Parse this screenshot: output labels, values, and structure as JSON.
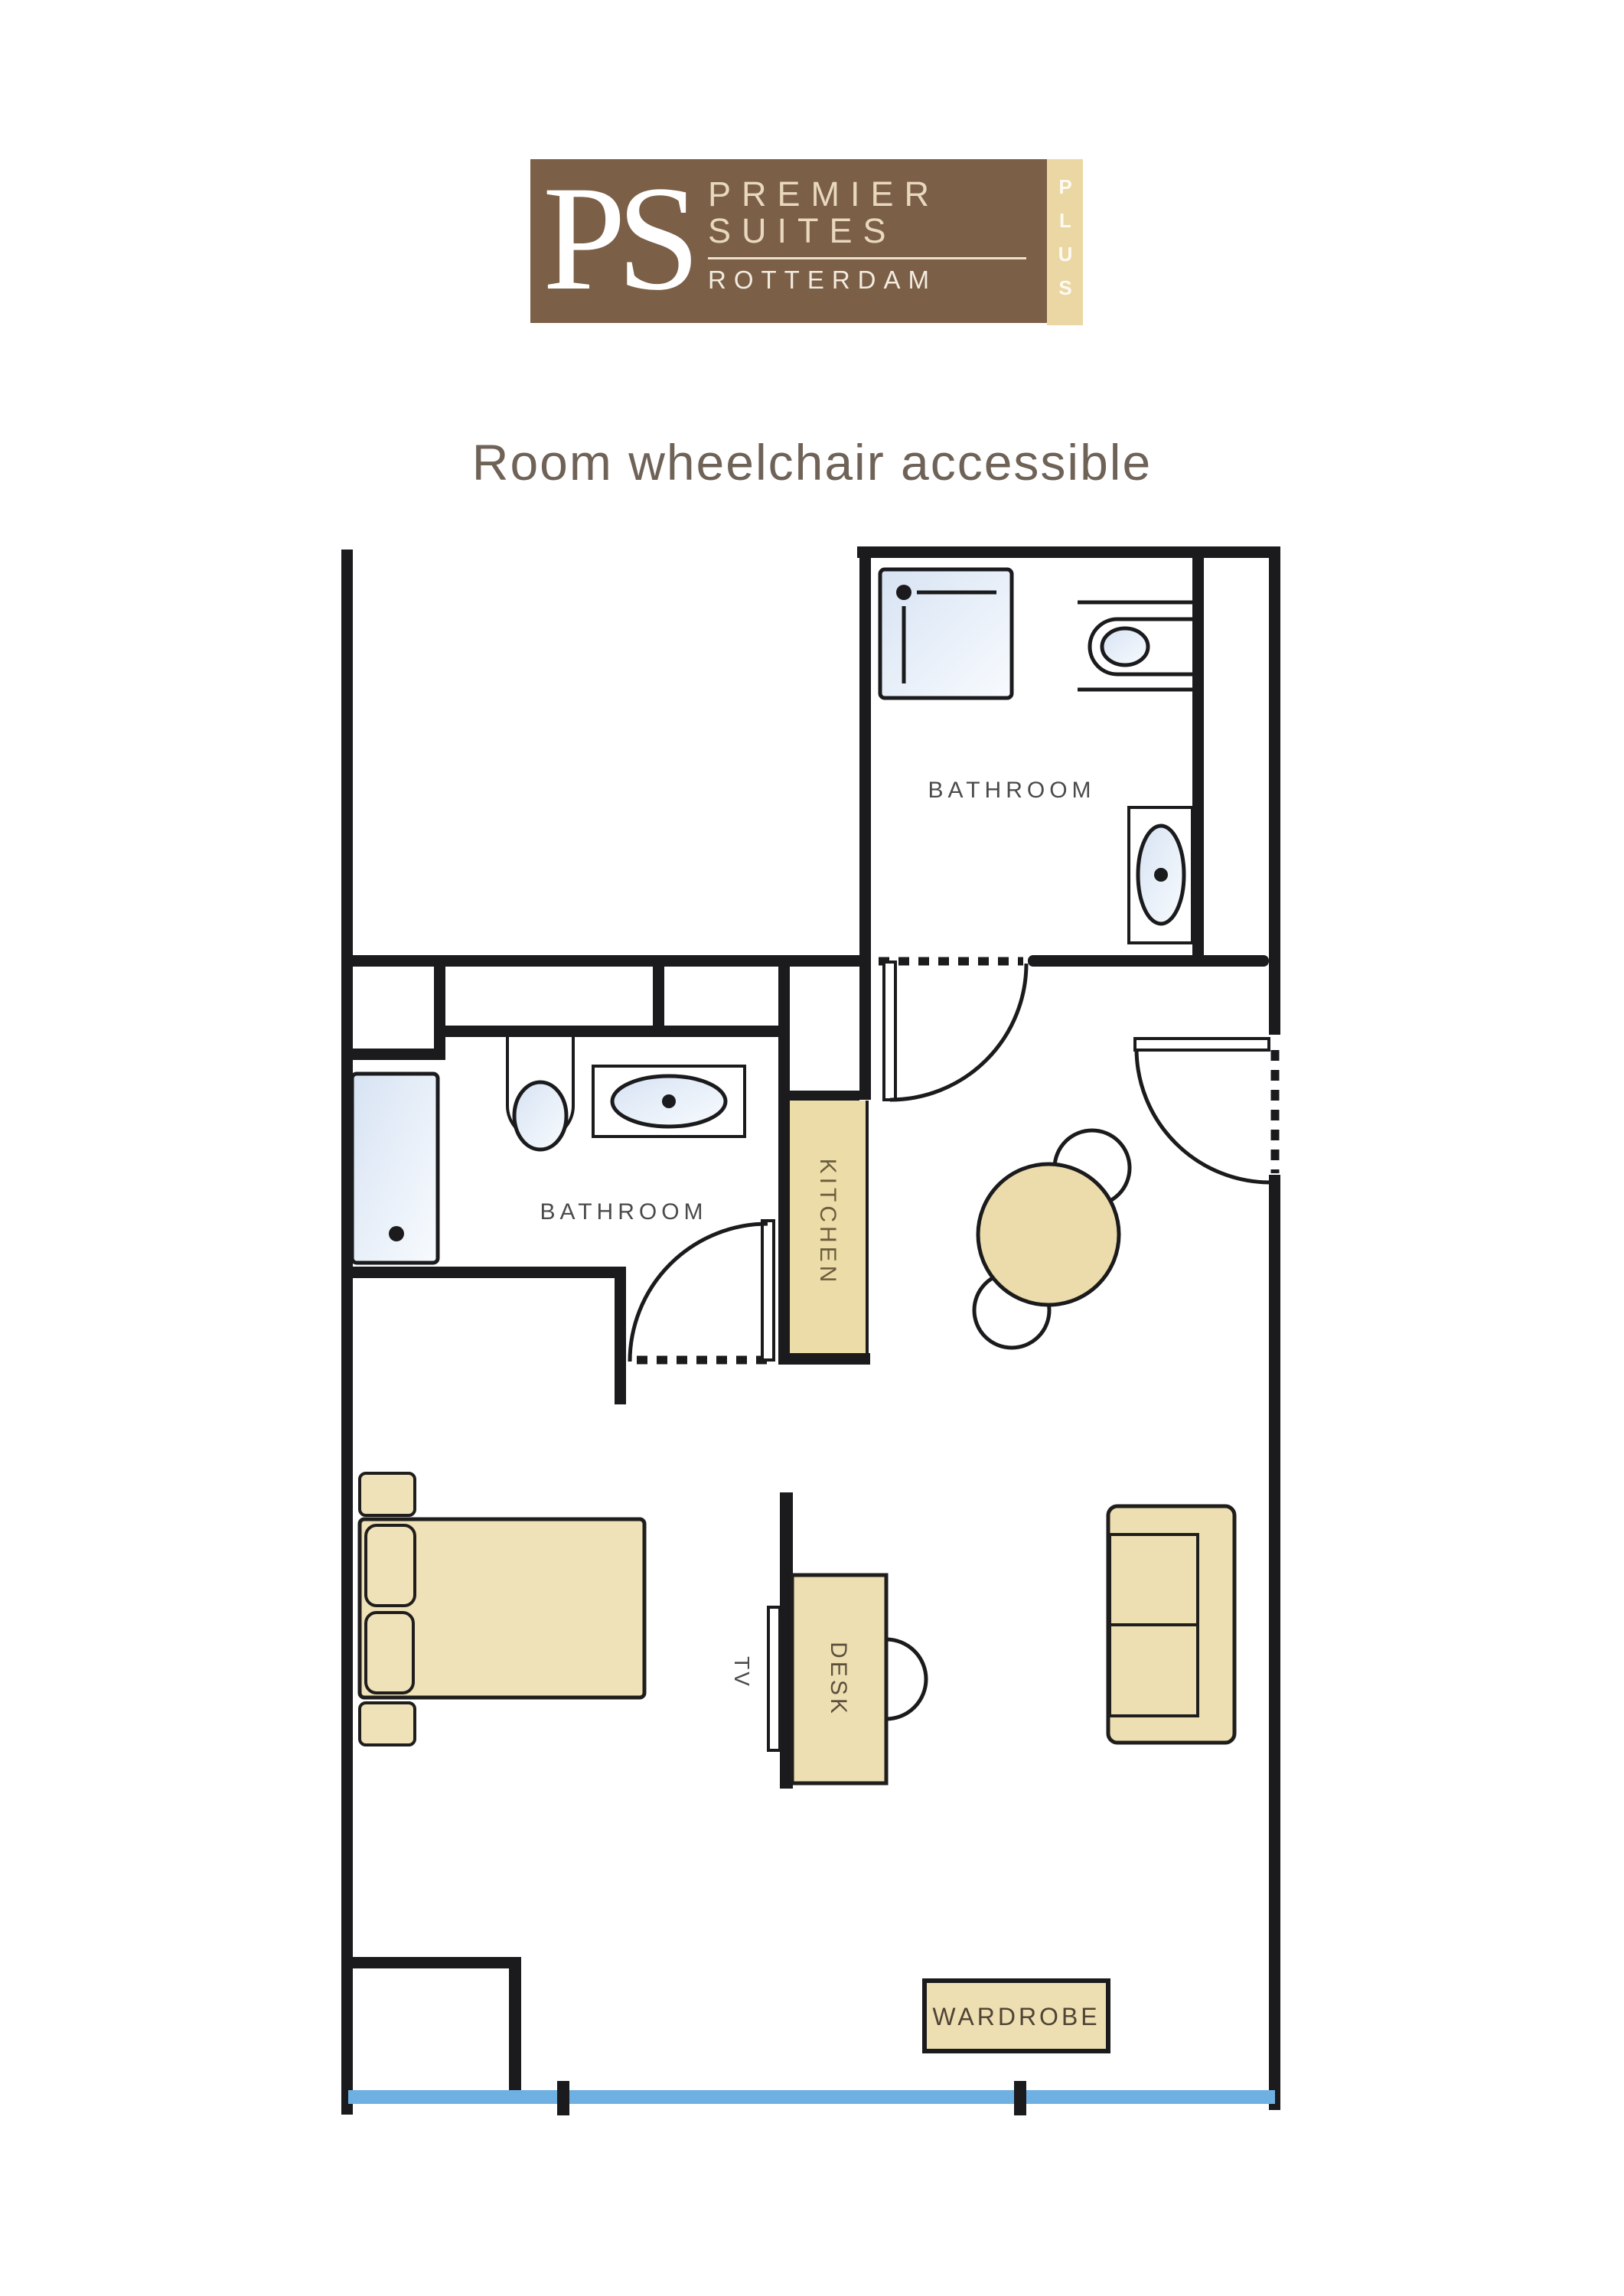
{
  "logo": {
    "monogram": "PS",
    "name_line1": "PREMIER",
    "name_line2": "SUITES",
    "city": "ROTTERDAM",
    "edition": "PLUS",
    "colors": {
      "brown": "#7B5F47",
      "cream_strip": "#EAD7A4",
      "cream_text": "#E8D8BE"
    }
  },
  "title": "Room wheelchair accessible",
  "floor_plan": {
    "rooms": {
      "bathroom_top": "BATHROOM",
      "bathroom_middle": "BATHROOM",
      "kitchen": "KITCHEN"
    },
    "furniture": {
      "tv": "TV",
      "desk": "DESK",
      "wardrobe": "WARDROBE"
    },
    "colors": {
      "wall": "#1B1B1D",
      "furniture_tan": "#EDDFB2",
      "kitchen_tan": "#EBDCA8",
      "fixture_light_blue": "#E3ECF7",
      "window_blue": "#6FB0E3",
      "label_gray": "#4B4B4B",
      "title_color": "#6F6257"
    }
  }
}
